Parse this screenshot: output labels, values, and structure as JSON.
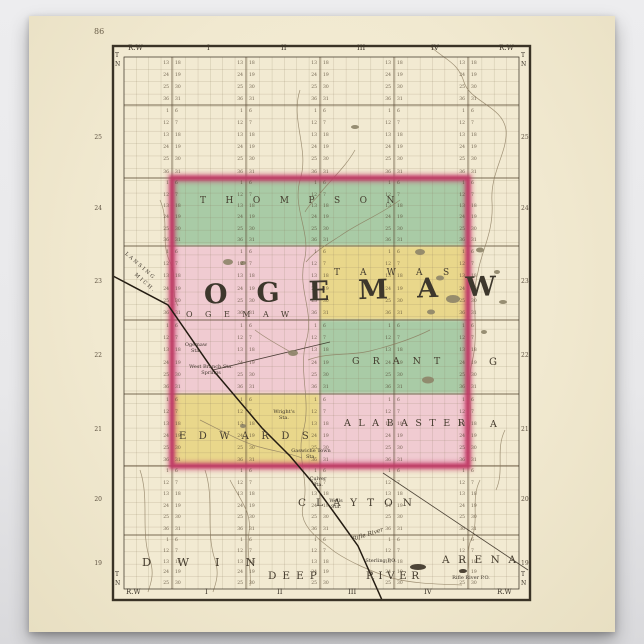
{
  "frame": {
    "page_number": "86",
    "range_label": "R.W",
    "t": "T",
    "n": "N",
    "numerals": [
      "I",
      "II",
      "III",
      "IV"
    ],
    "township_numbers": [
      "25",
      "24",
      "23",
      "22",
      "21",
      "20",
      "19"
    ]
  },
  "townships": {
    "thompson": "THOMPSON",
    "ogemaw_large": "OGEMAW",
    "ogemaw_small": "OGEMAW",
    "tawas": "TAWAS",
    "grant": "GRANT",
    "grant_stray": "G",
    "edwards": "EDWARDS",
    "alabaster": "ALABASTER",
    "alabaster_stray": "A",
    "clayton": "CLAYTON",
    "gladwin_partial": "DWIN",
    "deep": "DEEP",
    "river": "RIVER",
    "arenac": "ARENA"
  },
  "stations": {
    "ogemaw": "Ogemaw\nSta.",
    "west_branch": "West Branch Sta.\nSprings",
    "wrights": "Wright's\nSta.",
    "gaswiche": "Gaswiche Town\nSta.",
    "culver": "Culver\nSta.",
    "wells": "Wells\nSta.",
    "sterling": "Sterling P.O.",
    "rifle_river_po": "Rifle River P.O."
  },
  "annotations": {
    "rifle_river": "Rifle River",
    "railroad_1": "LANSING",
    "railroad_2": "MICH."
  },
  "colors": {
    "paper": "#f2ead2",
    "green": "#a9cba6",
    "pink": "#f0cbd1",
    "yellow": "#e9d78b",
    "county_border": "#c23a68",
    "grid": "#8b7b5f",
    "town_line": "#5a4a33",
    "river": "#8a795c",
    "rail": "#241c12",
    "ink": "#3a3326",
    "lake": "#8d8468",
    "lake_dark": "#3a3226"
  },
  "layout": {
    "grid": {
      "x0": 124,
      "y0": 57,
      "x1": 519,
      "y1": 589,
      "vstep": 12.34,
      "hstep": 12.37
    },
    "town_v": [
      172,
      246,
      320,
      394,
      468
    ],
    "town_h": [
      105,
      178,
      246,
      320,
      394,
      466,
      535
    ],
    "pair_lines_x": [
      172,
      246,
      320,
      394,
      468
    ],
    "left_cycle": [
      "1",
      "12",
      "13",
      "24",
      "25",
      "36"
    ],
    "right_cycle": [
      "6",
      "7",
      "18",
      "19",
      "30",
      "31"
    ],
    "bands": [
      {
        "y0": 57,
        "y1": 105,
        "rows": 4,
        "offset": 2
      },
      {
        "y0": 105,
        "y1": 178,
        "rows": 6,
        "offset": 0
      },
      {
        "y0": 178,
        "y1": 246,
        "rows": 6,
        "offset": 0
      },
      {
        "y0": 246,
        "y1": 320,
        "rows": 6,
        "offset": 0
      },
      {
        "y0": 320,
        "y1": 394,
        "rows": 6,
        "offset": 0
      },
      {
        "y0": 394,
        "y1": 466,
        "rows": 6,
        "offset": 0
      },
      {
        "y0": 466,
        "y1": 535,
        "rows": 6,
        "offset": 0
      },
      {
        "y0": 535,
        "y1": 589,
        "rows": 5,
        "offset": 0
      }
    ],
    "edge_number_ys": [
      134,
      205,
      278,
      352,
      426,
      496,
      560
    ]
  },
  "map": {
    "rivers": [
      "M430,46 C445,60 458,62 464,82 C470,102 503,106 506,130 C508,152 490,172 492,202 C494,232 481,252 478,272",
      "M478,272 C470,300 480,332 472,362 C466,388 474,412 468,436",
      "M300,90 C290,120 310,150 300,180 C292,210 312,232 304,262 C298,292 315,312 306,342 C298,372 312,402 303,432 C296,456 310,482 303,506 C298,526 320,540 335,552 C350,562 372,572 392,578 C414,584 440,584 462,585",
      "M355,150 C345,168 330,180 318,196 C312,203 308,206 305,212",
      "M400,200 C380,215 360,222 340,236 C326,245 314,252 306,262",
      "M430,330 C410,340 390,346 370,351 C350,356 328,352 308,360",
      "M255,330 C268,340 284,348 296,355",
      "M200,420 C220,430 240,441 256,446 C272,451 290,453 302,458",
      "M160,200 C170,222 160,242 170,262 C178,277 170,292 178,306",
      "M140,470 C150,500 140,530 150,560 C155,575 150,585 148,592",
      "M205,470 C215,500 205,530 215,560 C220,575 215,585 213,592",
      "M230,480 C240,500 252,512 249,532 C246,552 252,572 250,586",
      "M480,480 C470,500 480,520 471,540 C466,551 470,561 468,571",
      "M505,430 C495,450 505,470 496,490"
    ],
    "railroad": "M113,276 L168,305 L213,370 L235,396 L262,428 L290,456 L312,482 L338,518 L358,546 L382,600",
    "roads": [
      "M213,370 L330,342",
      "M383,473 L528,570"
    ],
    "lakes": [
      [
        228,
        262,
        5,
        3,
        0
      ],
      [
        243,
        263,
        3,
        2,
        0
      ],
      [
        355,
        127,
        4,
        2,
        0
      ],
      [
        420,
        252,
        5,
        3,
        0
      ],
      [
        440,
        278,
        4,
        2.5,
        0
      ],
      [
        453,
        299,
        7,
        4,
        0
      ],
      [
        431,
        312,
        4,
        2.5,
        0
      ],
      [
        428,
        380,
        6,
        3.5,
        0
      ],
      [
        293,
        353,
        5,
        3,
        0
      ],
      [
        243,
        426,
        3,
        2,
        0
      ],
      [
        480,
        250,
        4,
        2.5,
        0
      ],
      [
        497,
        272,
        3,
        2,
        0
      ],
      [
        503,
        302,
        4,
        2,
        0
      ],
      [
        484,
        332,
        3,
        2,
        0
      ],
      [
        418,
        567,
        8,
        3,
        1
      ],
      [
        463,
        571,
        4,
        2,
        1
      ]
    ]
  }
}
